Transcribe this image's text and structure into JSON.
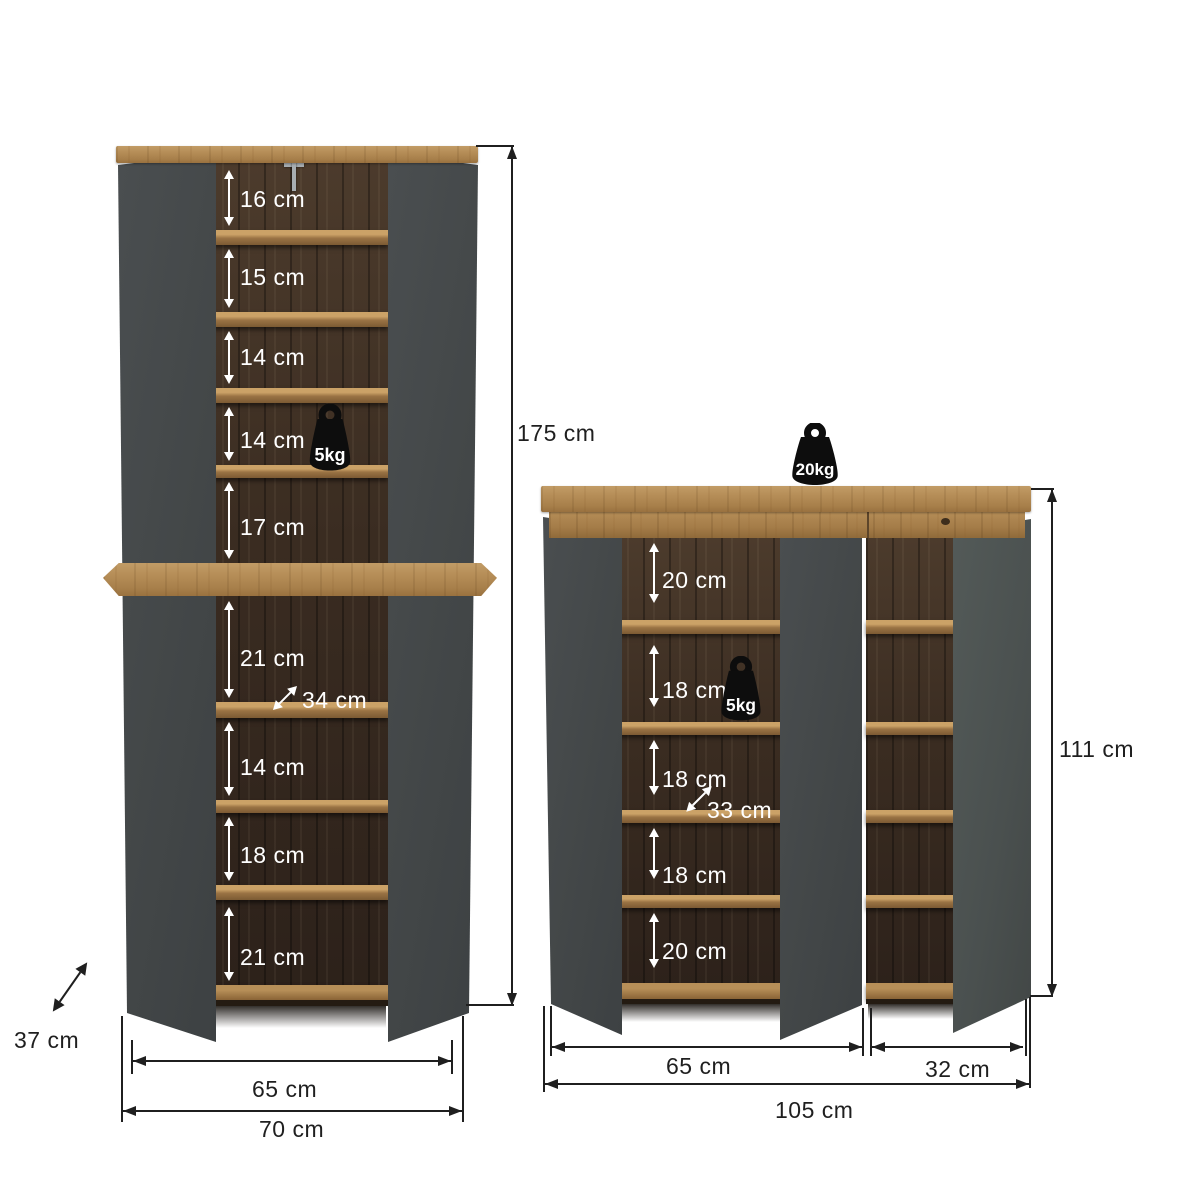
{
  "diagram": {
    "background": "#ffffff",
    "line_color": "#1f1f1f",
    "door_color": "#45494b",
    "oak_color": "#b08a55",
    "interior_color": "#382c22",
    "weight_icon_color": "#0d0d0d"
  },
  "left_cabinet": {
    "height": "175 cm",
    "depth": "37 cm",
    "interior_depth": "34 cm",
    "inner_width": "65 cm",
    "outer_width": "70 cm",
    "shelf_load": "5kg",
    "upper_sections": [
      "16 cm",
      "15 cm",
      "14 cm",
      "14 cm",
      "17 cm"
    ],
    "lower_sections": [
      "21 cm",
      "14 cm",
      "18 cm",
      "21 cm"
    ]
  },
  "right_cabinet": {
    "height": "111 cm",
    "top_load": "20kg",
    "shelf_load": "5kg",
    "interior_depth": "33 cm",
    "sections": [
      "20 cm",
      "18 cm",
      "18 cm",
      "18 cm",
      "20 cm"
    ],
    "left_section_width": "65 cm",
    "right_section_width": "32 cm",
    "total_width": "105 cm"
  }
}
